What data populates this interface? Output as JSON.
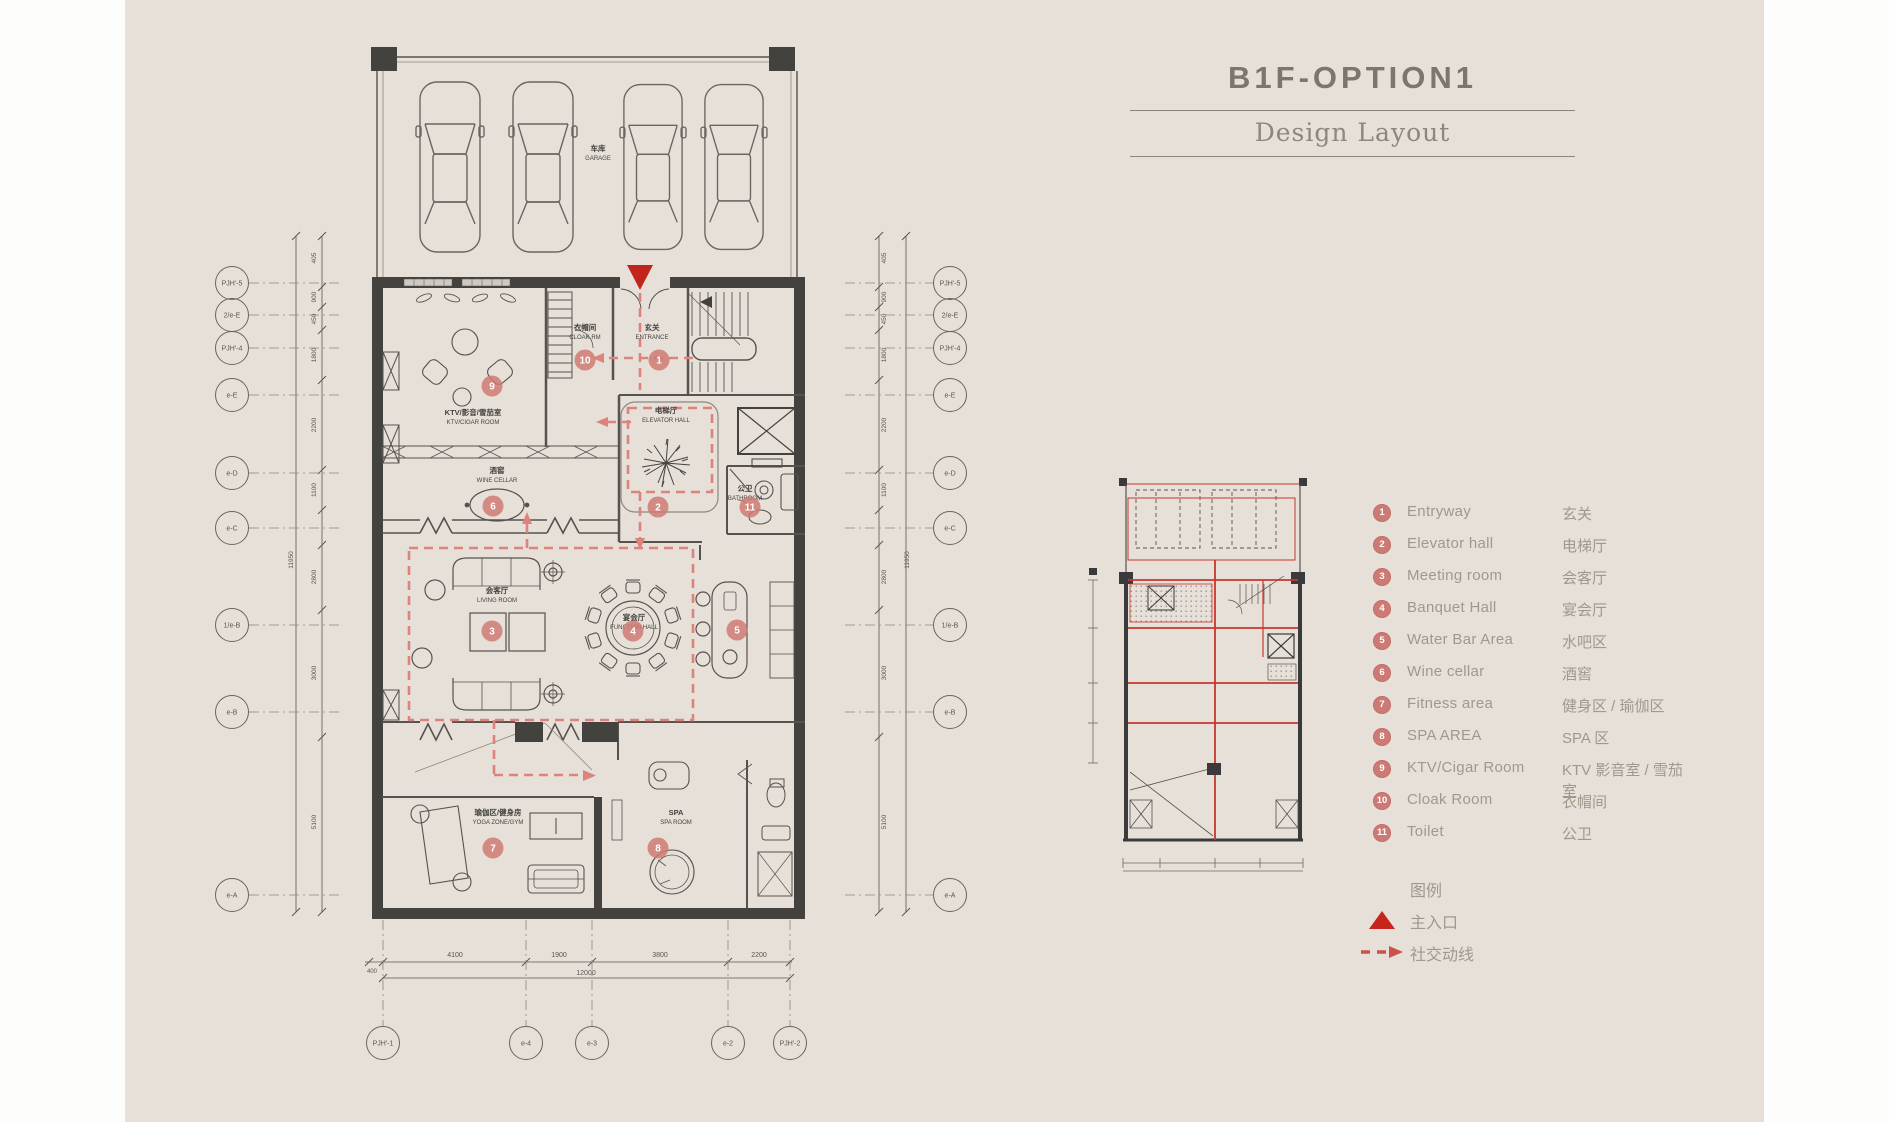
{
  "title": {
    "main": "B1F-OPTION1",
    "subtitle": "Design Layout"
  },
  "legend_items": [
    {
      "num": "1",
      "en": "Entryway",
      "cn": "玄关"
    },
    {
      "num": "2",
      "en": "Elevator hall",
      "cn": "电梯厅"
    },
    {
      "num": "3",
      "en": "Meeting room",
      "cn": "会客厅"
    },
    {
      "num": "4",
      "en": "Banquet Hall",
      "cn": "宴会厅"
    },
    {
      "num": "5",
      "en": "Water Bar Area",
      "cn": "水吧区"
    },
    {
      "num": "6",
      "en": "Wine cellar",
      "cn": "酒窖"
    },
    {
      "num": "7",
      "en": "Fitness area",
      "cn": "健身区 / 瑜伽区"
    },
    {
      "num": "8",
      "en": "SPA AREA",
      "cn": "SPA 区"
    },
    {
      "num": "9",
      "en": "KTV/Cigar Room",
      "cn": "KTV 影音室 / 雪茄室"
    },
    {
      "num": "10",
      "en": "Cloak Room",
      "cn": "衣帽间"
    },
    {
      "num": "11",
      "en": "Toilet",
      "cn": "公卫"
    }
  ],
  "key": {
    "heading": "图例",
    "entrance": "主入口",
    "circulation": "社交动线"
  },
  "plan": {
    "rooms": [
      {
        "id": "garage",
        "cn": "车库",
        "en": "GARAGE",
        "marker": ""
      },
      {
        "id": "ktv",
        "cn": "KTV/影音/雪茄室",
        "en": "KTV/CIGAR ROOM",
        "marker": "9"
      },
      {
        "id": "cloak",
        "cn": "衣帽间",
        "en": "CLOAK RM",
        "marker": "10"
      },
      {
        "id": "entrance",
        "cn": "玄关",
        "en": "ENTRANCE",
        "marker": "1"
      },
      {
        "id": "elevator",
        "cn": "电梯厅",
        "en": "ELEVATOR HALL",
        "marker": "2"
      },
      {
        "id": "wine",
        "cn": "酒窖",
        "en": "WINE CELLAR",
        "marker": "6"
      },
      {
        "id": "bathroom",
        "cn": "公卫",
        "en": "BATHROOM",
        "marker": "11"
      },
      {
        "id": "living",
        "cn": "会客厅",
        "en": "LIVING ROOM",
        "marker": "3"
      },
      {
        "id": "function",
        "cn": "宴会厅",
        "en": "FUNCTION HALL",
        "marker": "4"
      },
      {
        "id": "waterbar",
        "cn": "",
        "en": "",
        "marker": "5"
      },
      {
        "id": "yoga",
        "cn": "瑜伽区/健身房",
        "en": "YOGA ZONE/GYM",
        "marker": "7"
      },
      {
        "id": "spa",
        "cn": "SPA",
        "en": "SPA ROOM",
        "marker": "8"
      }
    ],
    "dims": {
      "left": [
        "405",
        "900",
        "450",
        "1800",
        "2200",
        "1100",
        "2800",
        "3000",
        "5100"
      ],
      "right": [
        "405",
        "900",
        "450",
        "1800",
        "2200",
        "1100",
        "2800",
        "3000",
        "5100"
      ],
      "left_total": "11950",
      "right_total": "11950",
      "bottom": [
        "4100",
        "1900",
        "3800",
        "2200"
      ],
      "bottom_small": "400",
      "bottom_total": "12000"
    },
    "grid_bubbles": {
      "left": [
        "PJH'-5",
        "2/e-E",
        "PJH'-4",
        "e-E",
        "e-D",
        "e-C",
        "1/e-B",
        "e-B",
        "e-A"
      ],
      "right": [
        "PJH'-5",
        "2/e-E",
        "PJH'-4",
        "e-E",
        "e-D",
        "e-C",
        "1/e-B",
        "e-B",
        "e-A"
      ],
      "bottom": [
        "PJH'-1",
        "e-4",
        "e-3",
        "e-2",
        "PJH'-2"
      ]
    }
  },
  "colors": {
    "background": "#e6e0d8",
    "accent_red": "#c1261d",
    "circulation_pink": "#dd837c",
    "marker_badge": "#cf7a74",
    "wall_dark": "#44423f",
    "line": "#57524d",
    "text_muted": "#a2978b"
  }
}
